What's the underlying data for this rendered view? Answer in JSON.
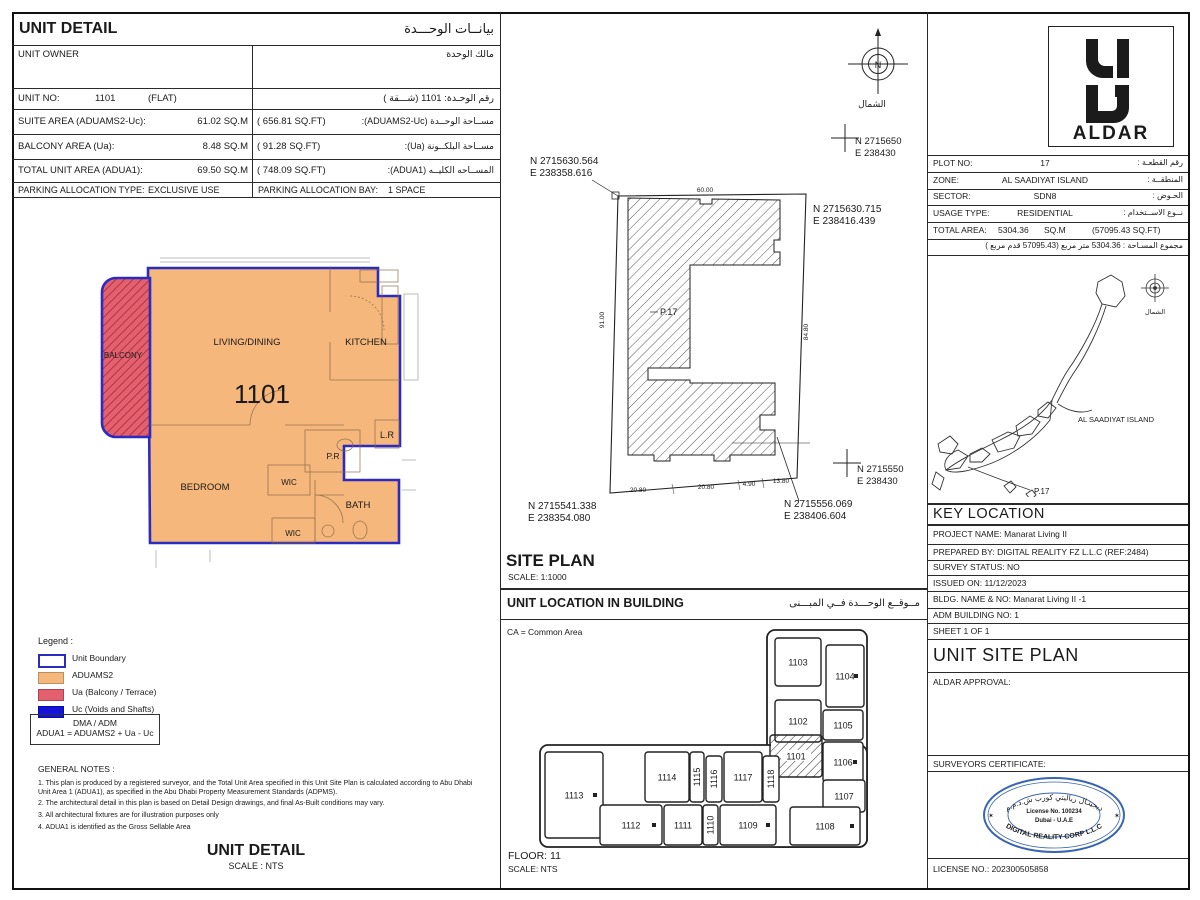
{
  "colors": {
    "unit_boundary": "#2b2bbf",
    "aduams2": "#f6b77c",
    "ua": "#e5606e",
    "uc": "#1414d8",
    "stamp_blue": "#3a66b0",
    "hatch_red": "#9c2b3d"
  },
  "unit_detail": {
    "title_en": "UNIT DETAIL",
    "title_ar": "بيانــات الوحـــدة",
    "owner_en": "UNIT OWNER",
    "owner_ar": "مالك الوحدة",
    "unit_no_label": "UNIT NO:",
    "unit_no_value": "1101",
    "unit_no_type": "(FLAT)",
    "unit_no_ar": "رقم الوحـدة:   1101   (شـــقة )",
    "suite_label": "SUITE AREA (ADUAMS2-Uc):",
    "suite_sqm": "61.02  SQ.M",
    "suite_sqft": "( 656.81   SQ.FT)",
    "suite_ar": "مســاحة الوحــدة (ADUAMS2-Uc):",
    "balcony_label": "BALCONY AREA (Ua):",
    "balcony_sqm": "8.48  SQ.M",
    "balcony_sqft": "(  91.28   SQ.FT)",
    "balcony_ar": "مســاحة البلكــونة (Ua):",
    "total_label": "TOTAL UNIT AREA (ADUA1):",
    "total_sqm": "69.50  SQ.M",
    "total_sqft": "( 748.09   SQ.FT)",
    "total_ar": "المســاحه الكليــه (ADUA1):",
    "parking_type_label": "PARKING ALLOCATION TYPE:",
    "parking_type_value": "EXCLUSIVE USE",
    "parking_bay_label": "PARKING ALLOCATION BAY:",
    "parking_bay_value": "1 SPACE"
  },
  "floor_plan": {
    "balcony": "BALCONY",
    "living": "LIVING/DINING",
    "kitchen": "KITCHEN",
    "unit_number": "1101",
    "pr": "P.R",
    "lr": "L.R",
    "wic_upper": "WIC",
    "bedroom": "BEDROOM",
    "bath": "BATH",
    "wic_lower": "WIC"
  },
  "legend": {
    "title": "Legend :",
    "items": [
      {
        "label": "Unit Boundary",
        "color": "#2b2bbf",
        "style": "outline"
      },
      {
        "label": "ADUAMS2",
        "color": "#f6b77c",
        "style": "fill"
      },
      {
        "label": "Ua (Balcony / Terrace)",
        "color": "#e5606e",
        "style": "fill"
      },
      {
        "label": "Uc (Voids and Shafts)",
        "color": "#1414d8",
        "style": "fill"
      }
    ],
    "dma_line1": "DMA / ADM",
    "dma_line2": "ADUA1 = ADUAMS2 + Ua - Uc"
  },
  "notes": {
    "title": "GENERAL NOTES :",
    "items": [
      "1. This plan is produced by a registered surveyor, and the Total Unit Area specified in this Unit Site Plan is calculated according to Abu Dhabi Unit Area 1 (ADUA1), as specified in the Abu Dhabi Property Measurement Standards (ADPMS).",
      "2. The architectural detail in this plan is based on Detail Design drawings, and final As-Built conditions may vary.",
      "3. All architectural fixtures are for illustration purposes only",
      "4. ADUA1 is identified as the Gross Sellable Area"
    ]
  },
  "unit_detail_footer": {
    "title": "UNIT DETAIL",
    "scale": "SCALE : NTS"
  },
  "site_plan": {
    "title": "SITE PLAN",
    "scale": "SCALE: 1:1000",
    "north_ar": "الشمال",
    "north_letter": "N",
    "plot_label": "P.17",
    "coord_tl_n": "N 2715630.564",
    "coord_tl_e": "E 238358.616",
    "coord_tr_n": "N 2715630.715",
    "coord_tr_e": "E 238416.439",
    "coord_bl_n": "N 2715541.338",
    "coord_bl_e": "E 238354.080",
    "coord_br_n": "N 2715556.069",
    "coord_br_e": "E 238406.604",
    "grid_top_n": "N 2715650",
    "grid_top_e": "E 238430",
    "grid_bot_n": "N 2715550",
    "grid_bot_e": "E 238430",
    "dim_top": "60.00",
    "dim_left": "91.00",
    "dim_right": "84.80",
    "dim_bottom": [
      "20.80",
      "20.80",
      "4.90",
      "13.80"
    ]
  },
  "unit_location": {
    "title_en": "UNIT LOCATION IN BUILDING",
    "title_ar": "مــوقــع الوحـــدة  فــي المبـــنى",
    "ca_note": "CA = Common Area",
    "floor": "FLOOR: 11",
    "scale": "SCALE:  NTS",
    "units": [
      "1103",
      "1104",
      "1102",
      "1105",
      "1101",
      "1106",
      "1107",
      "1113",
      "1114",
      "1115",
      "1116",
      "1117",
      "1118",
      "1112",
      "1111",
      "1110",
      "1109",
      "1108"
    ]
  },
  "right_panel": {
    "logo_text": "ALDAR",
    "plot_info": {
      "rows": [
        {
          "en": "PLOT NO:",
          "value": "17",
          "ar": "رقم القطعـة :"
        },
        {
          "en": "ZONE:",
          "value": "AL SAADIYAT ISLAND",
          "ar": "المنطقــة :"
        },
        {
          "en": "SECTOR:",
          "value": "SDN8",
          "ar": "الحـوض :"
        },
        {
          "en": "USAGE TYPE:",
          "value": "RESIDENTIAL",
          "ar": "نــوع الاســتخدام :"
        }
      ],
      "total_label": "TOTAL AREA:",
      "total_value": "5304.36",
      "total_unit": "SQ.M",
      "total_sqft": "(57095.43 SQ.FT)",
      "total_ar": "مجموع المسـاحة :   5304.36   متر مربع   (57095.43 قدم مربع )"
    },
    "map": {
      "island_label": "AL SAADIYAT ISLAND",
      "plot_label": "P.17",
      "north_ar": "الشمال"
    },
    "key_location": {
      "title": "KEY LOCATION",
      "rows": [
        "PROJECT NAME: Manarat Living II",
        "PREPARED BY: DIGITAL REALITY FZ L.L.C (REF:2484)",
        "SURVEY STATUS:  NO",
        "ISSUED ON: 11/12/2023",
        "BLDG. NAME & NO: Manarat Living II -1",
        "ADM BUILDING NO:  1",
        "SHEET  1 OF 1"
      ]
    },
    "unit_site_plan_title": "UNIT SITE PLAN",
    "aldar_approval": "ALDAR APPROVAL:",
    "surveyors_certificate": "SURVEYORS CERTIFICATE:",
    "stamp": {
      "arc_top_ar": "ديجيتـال رياليتي كورب ش.ذ.م.م",
      "center1": "License No. 100234",
      "center2": "Dubai - U.A.E",
      "arc_bottom": "DIGITAL REALITY CORP L.L.C"
    },
    "license": "LICENSE NO.: 202300505858"
  }
}
